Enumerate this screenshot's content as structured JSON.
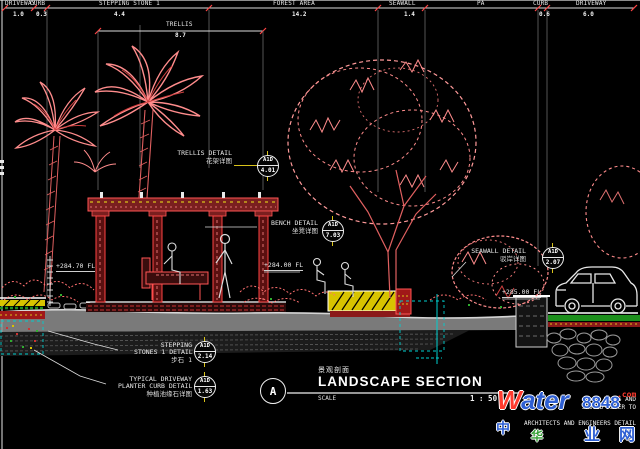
{
  "colors": {
    "background": "#000000",
    "linework": "#e9e9e9",
    "vegetation_pink": "#ff8c8c",
    "vegetation_red": "#d04040",
    "structure_red": "#ff5555",
    "highlight_yellow": "#d8c400",
    "aux_cyan": "#00cfcf",
    "grass_green": "#1f8f1f",
    "watermark_blue": "#2e5fd3",
    "watermark_red": "#ff3b2f"
  },
  "dim_chain": {
    "segments": [
      {
        "label": "DRIVEWAY",
        "value": "1.0"
      },
      {
        "label": "CURB",
        "value": "0.3"
      },
      {
        "label": "STEPPING STONE 1",
        "value": "4.4"
      },
      {
        "label": "FOREST AREA",
        "value": "14.2"
      },
      {
        "label": "SEAWALL",
        "value": "1.4"
      },
      {
        "label": "PA",
        "value": ""
      },
      {
        "label": "CURB",
        "value": "0.6"
      },
      {
        "label": "DRIVEWAY",
        "value": "6.0"
      }
    ],
    "trellis": {
      "label": "TRELLIS",
      "value": "8.7"
    }
  },
  "elevations": {
    "left": "+284.70 FL",
    "center": "+284.00 FL",
    "right": "+285.00 FL"
  },
  "callouts": {
    "trellis": {
      "line1": "TRELLIS DETAIL",
      "cn": "花架详图",
      "bubble_top": "A1D",
      "bubble_bottom": "4.01"
    },
    "bench": {
      "line1": "BENCH DETAIL",
      "cn": "坐凳详图",
      "bubble_top": "A1D",
      "bubble_bottom": "7.03"
    },
    "seawall": {
      "line1": "SEAWALL DETAIL",
      "cn": "驳岸详图",
      "bubble_top": "A1D",
      "bubble_bottom": "2.07"
    },
    "stepping": {
      "line1": "STEPPING",
      "line2": "STONES 1 DETAIL",
      "cn": "步石 1",
      "bubble_top": "A1D",
      "bubble_bottom": "2.14"
    },
    "planter": {
      "line1": "TYPICAL DRIVEWAY",
      "line2": "PLANTER CURB DETAIL",
      "cn": "种植池缘石详图",
      "bubble_top": "A1D",
      "bubble_bottom": "1.63"
    }
  },
  "title_block": {
    "section_letter": "A",
    "cn": "景观剖面",
    "title": "LANDSCAPE SECTION",
    "scale_label": "SCALE",
    "scale_value": "1 : 50"
  },
  "watermark": {
    "brand_w": "W",
    "brand_rest": "ater",
    "brand_num": "8848",
    "brand_dot": ".com",
    "cn_chars": {
      "c1": "中",
      "c2": "华",
      "c3": "业",
      "c4": "网"
    },
    "notes": {
      "n1": "OROUS AND",
      "n2": "SHOULD REFER TO",
      "n3": "ARCHITECTS AND ENGINEERS DETAIL"
    }
  }
}
